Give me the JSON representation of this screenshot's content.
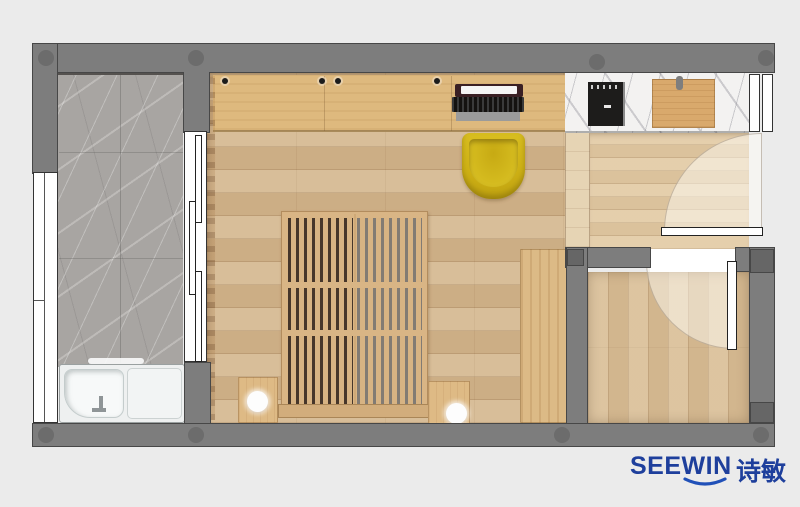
{
  "brand": {
    "logo_en": "SEEWIN",
    "logo_zh": "诗敏",
    "logo_color": "#1e3f9c",
    "swoosh_icon": "smile-swoosh-icon"
  },
  "palette": {
    "background": "#ebebeb",
    "wall": "#7d7d7d",
    "wall_column": "#6c6c6c",
    "balcony_marble": "#a8a5a2",
    "bedroom_floor": "#d3b68e",
    "desk_wood": "#deb97e",
    "counter_marble": "#f3f2f1",
    "cooktop_black": "#1d1c1b",
    "cutting_board": "#d9a96c",
    "entry_floor": "#e1c9a4",
    "bathroom_floor": "#d8bd96",
    "bed_wood": "#d9b585",
    "bed_slat_gap_dark": "#46362a",
    "bed_slat_gap_light": "#827b73",
    "chair_yellow": "#d2b418",
    "wardrobe_wood": "#dcba86",
    "fixture_white": "#f4f6f6"
  },
  "objects": [
    {
      "name": "balcony-marble-floor"
    },
    {
      "name": "left-window"
    },
    {
      "name": "sliding-glass-door"
    },
    {
      "name": "curtain"
    },
    {
      "name": "bathtub"
    },
    {
      "name": "desk-with-laptop"
    },
    {
      "name": "yellow-tub-chair"
    },
    {
      "name": "slatted-bed"
    },
    {
      "name": "nightstand-with-lamp-left"
    },
    {
      "name": "nightstand-with-lamp-right"
    },
    {
      "name": "wardrobe"
    },
    {
      "name": "marble-counter"
    },
    {
      "name": "induction-cooktop"
    },
    {
      "name": "cutting-board"
    },
    {
      "name": "entry-door-with-swing"
    },
    {
      "name": "bathroom-door-with-swing"
    },
    {
      "name": "bathroom"
    }
  ]
}
